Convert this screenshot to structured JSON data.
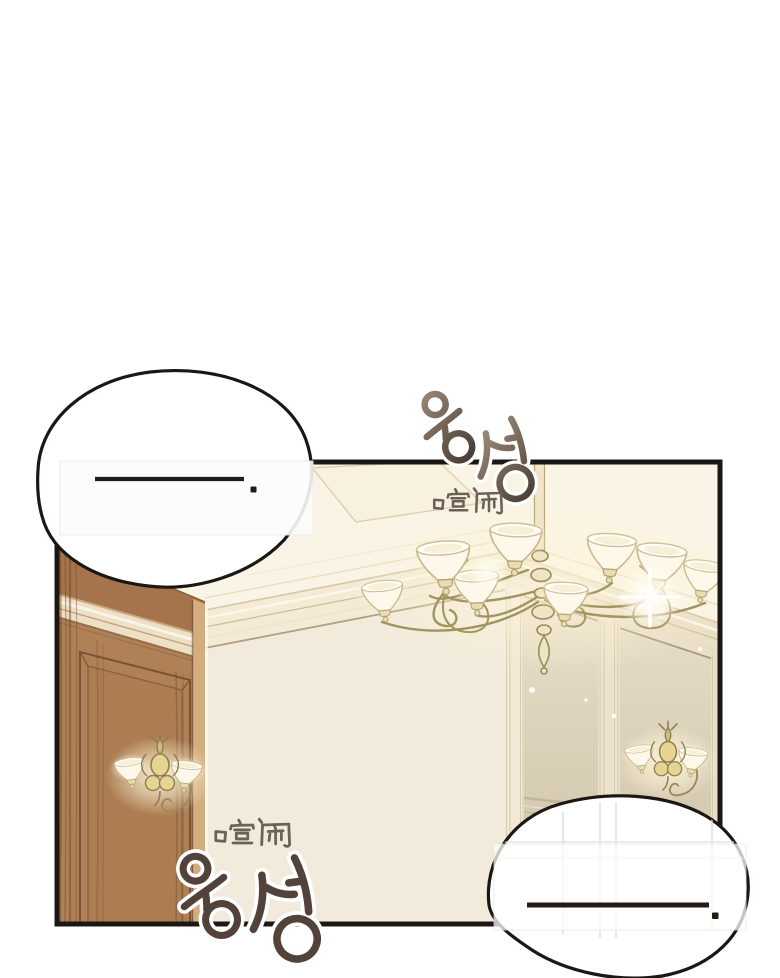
{
  "meta": {
    "kind": "webtoon-comic-panel"
  },
  "theme": {
    "page_bg": "#ffffff",
    "line": "#1c1712",
    "wood": "#b08157",
    "wood_dark": "#6e4a2e",
    "ceiling": "#faf4e6",
    "back_wall": "#f2ebdc",
    "brass": "#a2945e",
    "sfx_ink": "#52423a",
    "hanzi_ink": "#6b6156"
  },
  "panel": {
    "border_color": "#1c1712"
  },
  "speech_bubbles": [
    {
      "position": "top-left",
      "text": "──."
    },
    {
      "position": "bottom-right",
      "text": "──."
    }
  ],
  "sfx": [
    {
      "position": "top",
      "korean": "웅성",
      "chinese": "喧闹"
    },
    {
      "position": "bottom",
      "korean": "웅성",
      "chinese": "喧闹"
    }
  ],
  "scene": {
    "objects": [
      "chandelier",
      "wall-sconce-left",
      "wall-sconce-right",
      "wood-cabinet",
      "crown-molding",
      "wall-panels"
    ]
  }
}
